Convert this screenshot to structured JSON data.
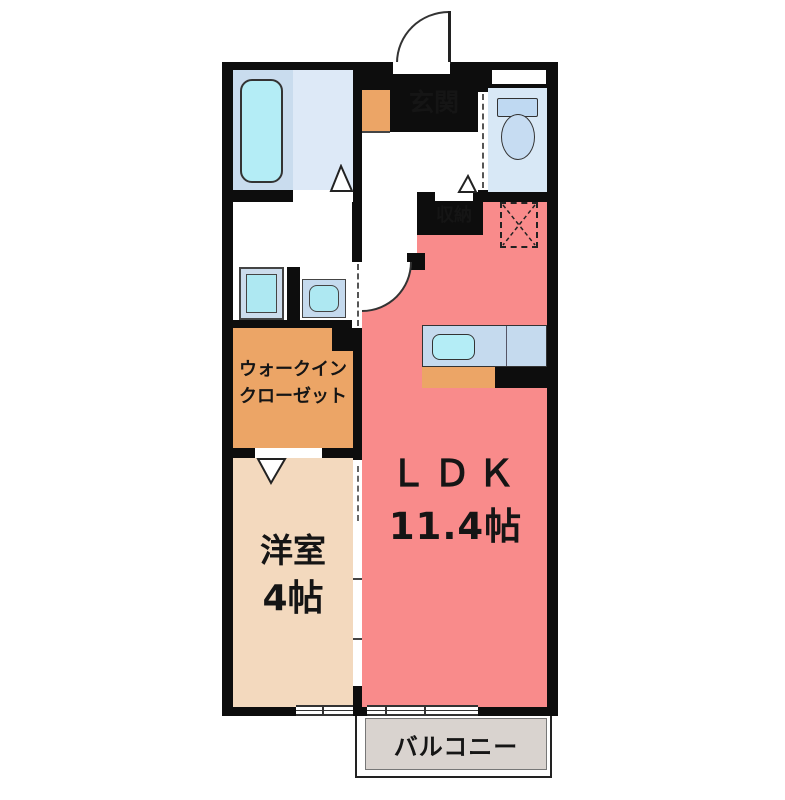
{
  "floor_plan": {
    "rooms": {
      "entrance": {
        "label": "玄関"
      },
      "storage": {
        "label": "収納"
      },
      "walk_in_closet": {
        "label_line1": "ウォークイン",
        "label_line2": "クローゼット"
      },
      "bedroom": {
        "label": "洋室",
        "size": "4帖"
      },
      "ldk": {
        "label": "ＬＤＫ",
        "size": "11.4帖"
      },
      "balcony": {
        "label": "バルコニー"
      }
    },
    "fixtures": [
      "bathtub",
      "washing-machine",
      "washroom-sink",
      "toilet",
      "kitchen-sink",
      "kitchen-counter",
      "refrigerator-space",
      "shoe-cabinet",
      "entrance-door",
      "room-doors",
      "sliding-doors",
      "windows"
    ],
    "palette": {
      "wall": "#0d0d0d",
      "ldk_pink": "#f98b8b",
      "bedroom_beige": "#f3d9be",
      "closet_orange": "#eca566",
      "entrance_gray": "#d2d2d2",
      "balcony_gray": "#d9d3cf",
      "bath_blue": "#c9dcee",
      "bath_blue_light": "#dde9f7",
      "fixture_cyan": "#b4edf6",
      "toilet_blue": "#d8e8f6"
    }
  }
}
